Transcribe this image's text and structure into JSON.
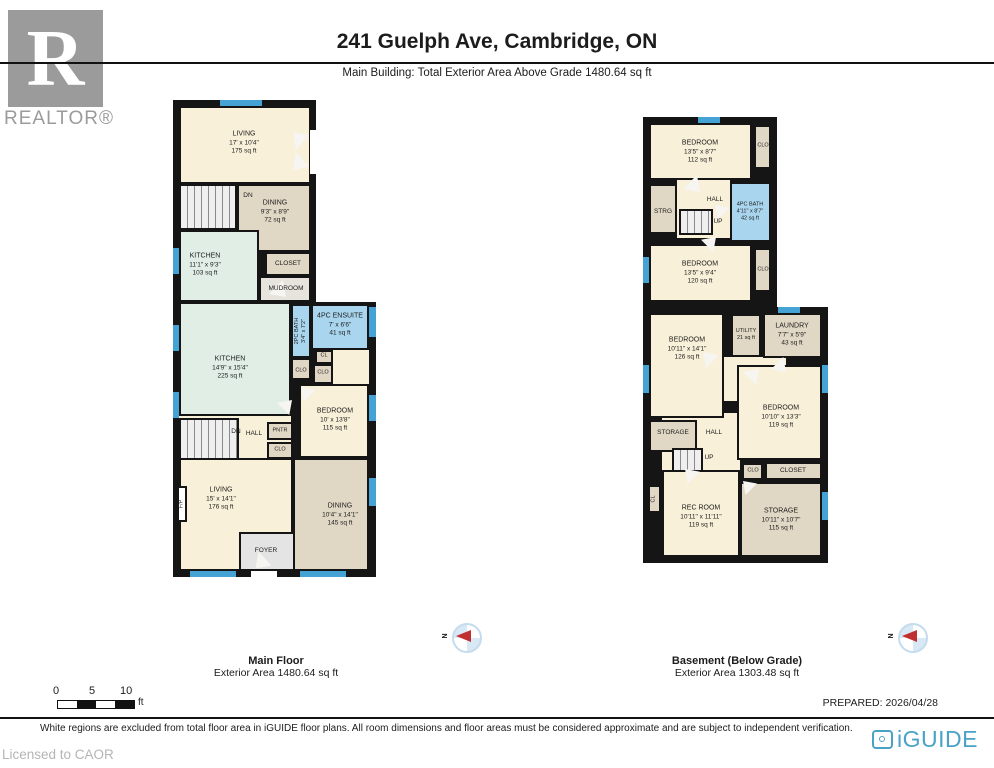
{
  "header": {
    "title": "241 Guelph Ave, Cambridge, ON",
    "subtitle": "Main Building: Total Exterior Area Above Grade 1480.64 sq ft",
    "realtor_logo_letter": "R",
    "realtor_logo_word": "REALTOR®"
  },
  "main_floor": {
    "caption_title": "Main Floor",
    "caption_area": "Exterior Area 1480.64 sq ft",
    "compass_label": "N",
    "rooms": [
      {
        "name": "LIVING",
        "dims": "17' x 10'4\"",
        "area": "175 sq ft"
      },
      {
        "name": "DN"
      },
      {
        "name": "DINING",
        "dims": "9'3\" x 8'9\"",
        "area": "72 sq ft"
      },
      {
        "name": "KITCHEN",
        "dims": "11'1\" x 9'3\"",
        "area": "103 sq ft"
      },
      {
        "name": "CLOSET"
      },
      {
        "name": "MUDROOM"
      },
      {
        "name": "2PC BATH",
        "dims": "3'4\" x 7'2\""
      },
      {
        "name": "4PC ENSUITE",
        "dims": "7' x 6'6\"",
        "area": "41 sq ft"
      },
      {
        "name": "CL"
      },
      {
        "name": "KITCHEN",
        "dims": "14'9\" x 15'4\"",
        "area": "225 sq ft"
      },
      {
        "name": "CLO"
      },
      {
        "name": "CLO"
      },
      {
        "name": "BEDROOM",
        "dims": "10' x 13'8\"",
        "area": "115 sq ft"
      },
      {
        "name": "DN"
      },
      {
        "name": "HALL"
      },
      {
        "name": "PNTR"
      },
      {
        "name": "CLO"
      },
      {
        "name": "LIVING",
        "dims": "15' x 14'1\"",
        "area": "176 sq ft"
      },
      {
        "name": "F/P"
      },
      {
        "name": "DINING",
        "dims": "10'4\" x 14'1\"",
        "area": "145 sq ft"
      },
      {
        "name": "FOYER"
      }
    ]
  },
  "basement": {
    "caption_title": "Basement (Below Grade)",
    "caption_area": "Exterior Area 1303.48 sq ft",
    "compass_label": "N",
    "rooms": [
      {
        "name": "BEDROOM",
        "dims": "13'5\" x 8'7\"",
        "area": "112 sq ft"
      },
      {
        "name": "CLO"
      },
      {
        "name": "STRG"
      },
      {
        "name": "HALL"
      },
      {
        "name": "UP"
      },
      {
        "name": "4PC BATH",
        "dims": "4'11\" x 8'7\"",
        "area": "42 sq ft"
      },
      {
        "name": "BEDROOM",
        "dims": "13'5\" x 9'4\"",
        "area": "120 sq ft"
      },
      {
        "name": "CLO"
      },
      {
        "name": "BEDROOM",
        "dims": "10'11\" x 14'1\"",
        "area": "126 sq ft"
      },
      {
        "name": "UTILITY",
        "area": "21 sq ft"
      },
      {
        "name": "LAUNDRY",
        "dims": "7'7\" x 5'9\"",
        "area": "43 sq ft"
      },
      {
        "name": "BEDROOM",
        "dims": "10'10\" x 13'3\"",
        "area": "119 sq ft"
      },
      {
        "name": "STORAGE"
      },
      {
        "name": "HALL"
      },
      {
        "name": "UP"
      },
      {
        "name": "CLO"
      },
      {
        "name": "CLOSET"
      },
      {
        "name": "CL"
      },
      {
        "name": "REC ROOM",
        "dims": "10'11\" x 11'11\"",
        "area": "119 sq ft"
      },
      {
        "name": "STORAGE",
        "dims": "10'11\" x 10'7\"",
        "area": "115 sq ft"
      }
    ]
  },
  "scale_bar": {
    "tick_0": "0",
    "tick_5": "5",
    "tick_10": "10",
    "unit": "ft"
  },
  "footer": {
    "prepared": "PREPARED: 2026/04/28",
    "disclaimer": "White regions are excluded from total floor area in iGUIDE floor plans. All room dimensions and floor areas must be considered approximate and are subject to independent verification.",
    "licensed": "Licensed to CAOR",
    "brand": "iGUIDE"
  },
  "colors": {
    "wall": "#151515",
    "room_cream": "#f9f0d9",
    "room_tan": "#e1d7c5",
    "room_mint": "#e0eee6",
    "room_bath_blue": "#a9d6ee",
    "window_blue": "#45a2d4",
    "brand_blue": "#4aa3c7",
    "compass_red": "#c03030",
    "logo_gray": "#9b9b9b"
  }
}
